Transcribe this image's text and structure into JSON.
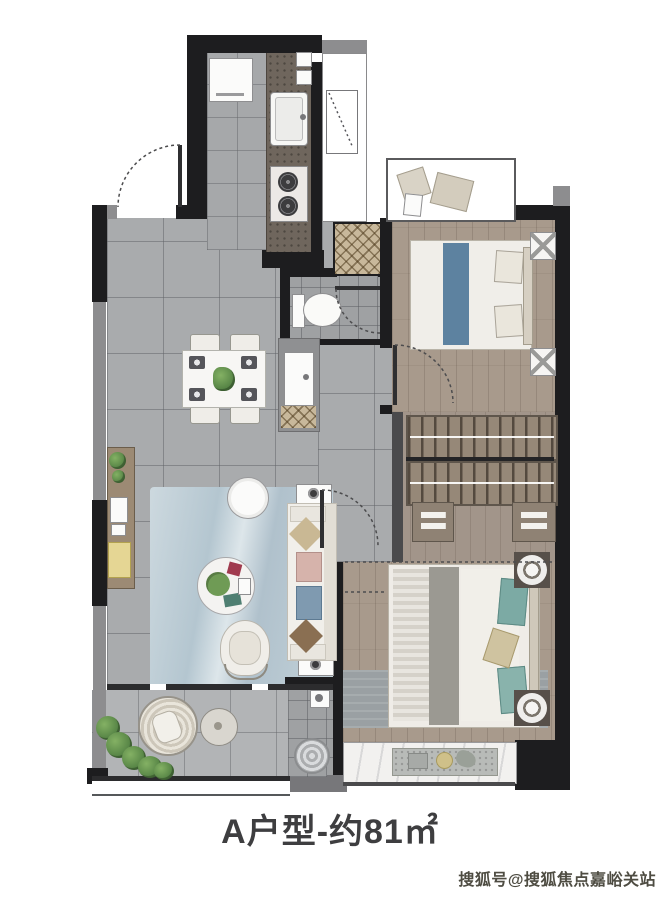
{
  "title": {
    "text": "A户型-约81㎡"
  },
  "watermark": {
    "text": "搜狐号@搜狐焦点嘉峪关站"
  },
  "palette": {
    "wall": "#1d1d1f",
    "wall_light": "#8d8d8f",
    "floor_tile": "#a9abad",
    "balcony_tile": "#b2b4b6",
    "wood_floor": "#a89a8c",
    "counter_granite": "#6f665d",
    "rug_blue": "#bfcfd8",
    "rug_grey": "#9aa0a3",
    "bed_runner_blue": "#5d82a0",
    "pillow_teal": "#7caaa4",
    "plant_green": "#5e8c4e",
    "stool_yellow": "#e5d694",
    "shaft_hatch_tan": "#c8b89b"
  },
  "rooms": [
    {
      "name": "kitchen",
      "furniture": [
        "refrigerator",
        "counter",
        "sink",
        "gas-stove",
        "meter-boxes"
      ]
    },
    {
      "name": "utility-flue",
      "furniture": [
        "window"
      ]
    },
    {
      "name": "secondary-bedroom",
      "furniture": [
        "double-bed",
        "nightstand",
        "nightstand",
        "bay-window-cushions",
        "door"
      ]
    },
    {
      "name": "walk-in-closet",
      "furniture": [
        "hanging-rack",
        "hanging-rack",
        "drawer-cabinet",
        "drawer-cabinet"
      ]
    },
    {
      "name": "master-bedroom",
      "furniture": [
        "double-bed",
        "round-nightstand",
        "round-nightstand",
        "rug",
        "bay-window-shelf"
      ]
    },
    {
      "name": "bathroom",
      "furniture": [
        "toilet",
        "vanity-basin",
        "door"
      ]
    },
    {
      "name": "hallway",
      "furniture": [
        "door"
      ]
    },
    {
      "name": "dining-area",
      "furniture": [
        "dining-table",
        "chair",
        "chair",
        "chair",
        "chair",
        "side-cabinet",
        "entry-mat"
      ]
    },
    {
      "name": "living-room",
      "furniture": [
        "sofa",
        "coffee-table",
        "side-table",
        "armchair",
        "tv-console",
        "rug",
        "end-table",
        "end-table"
      ]
    },
    {
      "name": "balcony",
      "furniture": [
        "lounge-chair",
        "round-table",
        "plants",
        "floor-drain",
        "tap"
      ]
    },
    {
      "name": "entry",
      "furniture": [
        "door"
      ]
    }
  ]
}
